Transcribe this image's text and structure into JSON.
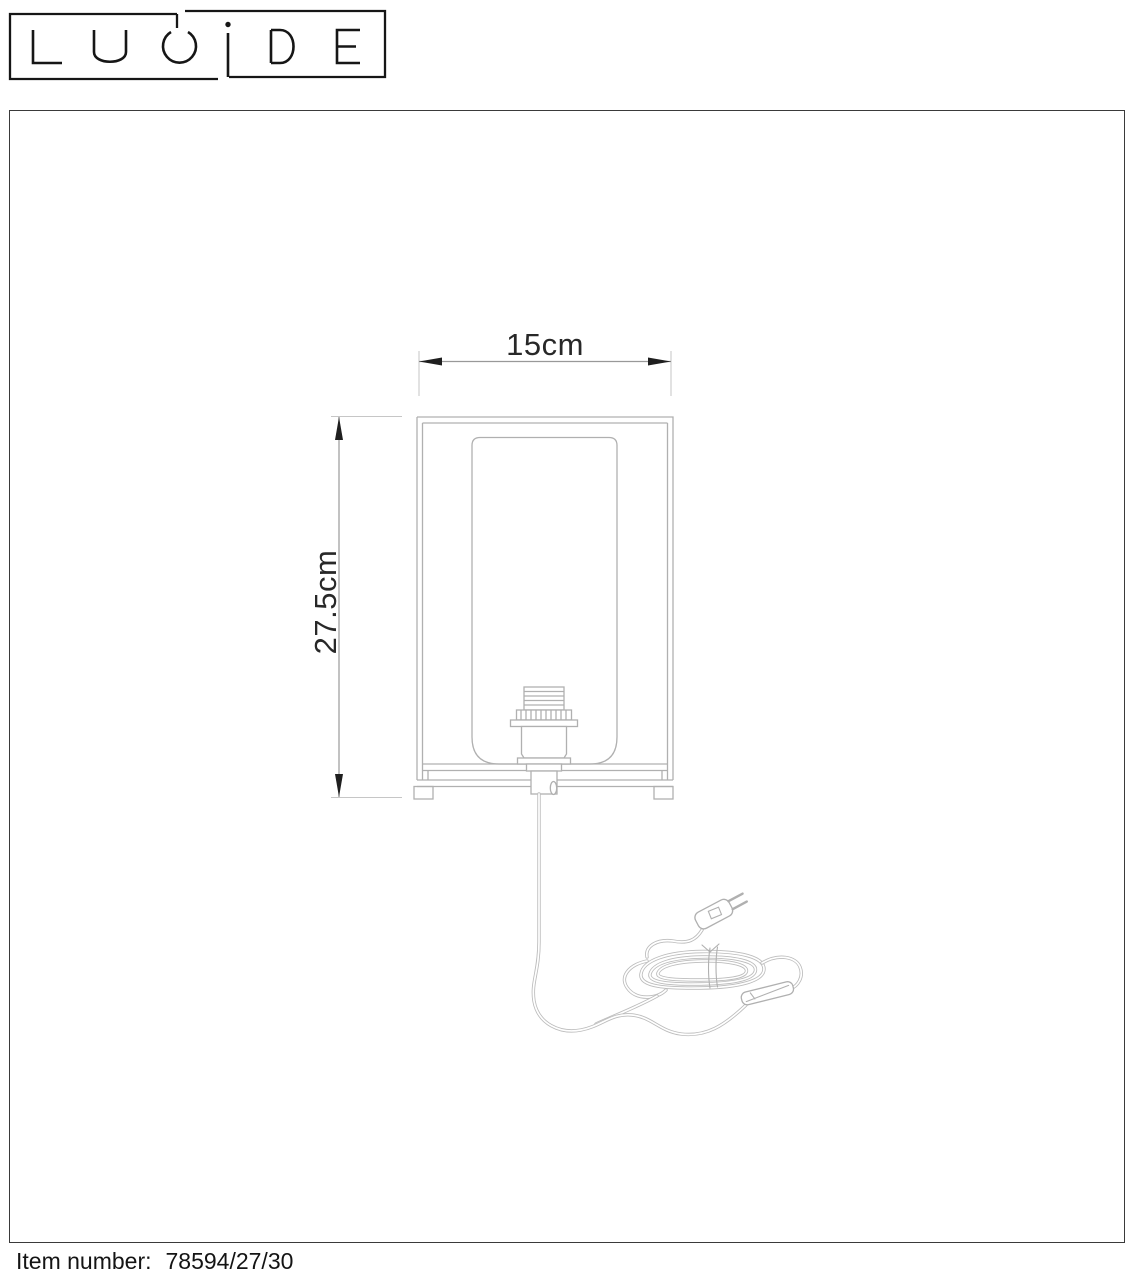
{
  "logo": {
    "brand": "LUCIDE"
  },
  "drawing": {
    "width_label": "15cm",
    "height_label": "27.5cm"
  },
  "footer": {
    "item_label": "Item number:",
    "item_number": "78594/27/30"
  },
  "colors": {
    "background": "#ffffff",
    "border": "#3a3a3a",
    "logo": "#161616",
    "drawing_line": "#b0b0b0",
    "cord_line": "#bcbcbc",
    "dimension_line": "#999999",
    "extension_line": "#c6c6c6",
    "arrow": "#1f1f1f",
    "dimension_text": "#282828",
    "footer_text": "#141414"
  }
}
